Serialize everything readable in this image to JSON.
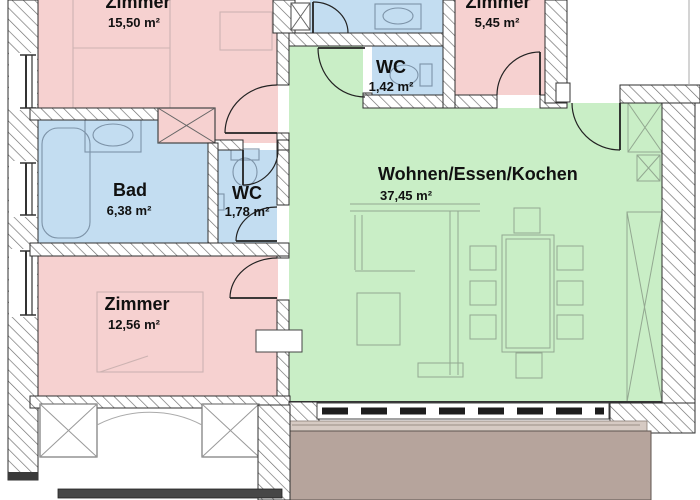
{
  "floorplan": {
    "rooms": [
      {
        "name": "Zimmer",
        "area": "15,50 m²"
      },
      {
        "name": "Zimmer",
        "area": "5,45 m²"
      },
      {
        "name": "WC",
        "area": "1,42 m²"
      },
      {
        "name": "Bad",
        "area": "6,38 m²"
      },
      {
        "name": "WC",
        "area": "1,78 m²"
      },
      {
        "name": "Wohnen/Essen/Kochen",
        "area": "37,45 m²"
      },
      {
        "name": "Zimmer",
        "area": "12,56 m²"
      }
    ],
    "colors": {
      "bedroom": "#f6d1d0",
      "bath": "#c3ddf1",
      "living": "#c9eec6",
      "terrace": "#b6a49c",
      "threshold": "#d6cac3"
    }
  }
}
